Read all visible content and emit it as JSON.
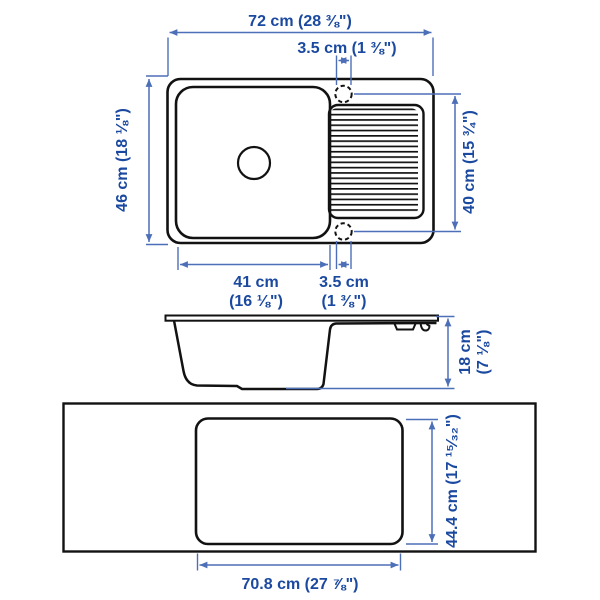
{
  "colors": {
    "dimension_text": "#1b49a0",
    "dimension_line": "#4d6fb8",
    "outline": "#121212",
    "background": "#ffffff"
  },
  "dimensions": {
    "overall_width": "72 cm (28 ⅜\")",
    "faucet_hole_top": "3.5 cm (1 ⅜\")",
    "overall_depth": "46 cm (18 ⅛\")",
    "right_span": "40 cm (15 ¾\")",
    "bowl_width_line1": "41 cm",
    "bowl_width_line2": "(16 ⅛\")",
    "faucet_hole_bottom_line1": "3.5 cm",
    "faucet_hole_bottom_line2": "(1 ⅜\")",
    "height_line1": "18 cm",
    "height_line2": "(7 ⅛\")",
    "cutout_depth": "44.4 cm (17 ¹⁵⁄₃₂\")",
    "cutout_width": "70.8 cm (27 ⅞\")"
  }
}
